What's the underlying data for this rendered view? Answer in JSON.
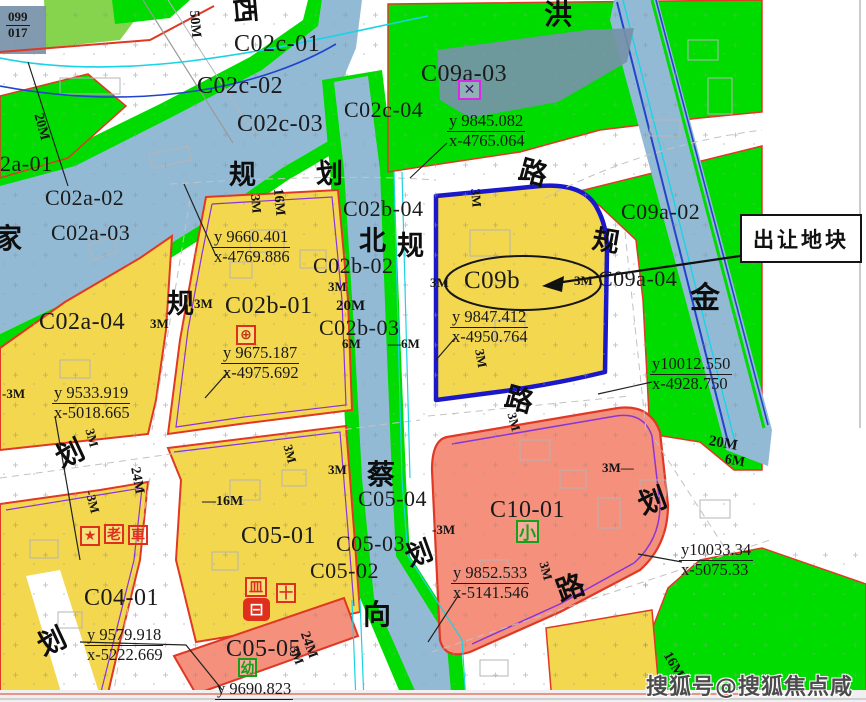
{
  "callout": {
    "label": "出让地块"
  },
  "watermark": {
    "text": "搜狐号@搜狐焦点咸宁站"
  },
  "highlight_parcel": {
    "id": "C09b"
  },
  "colors": {
    "green": "#00dc00",
    "ygreen": "#86d44e",
    "yellow": "#f3d84f",
    "water": "#93bad5",
    "salmon": "#f4907c",
    "slate": "#7691a9",
    "red-border": "#e03824",
    "navy": "#1a18c8",
    "violet": "#8a35d6",
    "cyan": "#19d3e6",
    "blue-line": "#2244cc",
    "magenta": "#d928e8",
    "icon-red": "#df2f1d",
    "icon-green": "#18a018"
  },
  "labels": [
    {
      "t": "C02c-01",
      "x": 234,
      "y": 32,
      "fs": 24,
      "k": "parcel"
    },
    {
      "t": "C02c-02",
      "x": 197,
      "y": 74,
      "fs": 24,
      "k": "parcel"
    },
    {
      "t": "C02c-03",
      "x": 237,
      "y": 112,
      "fs": 24,
      "k": "parcel"
    },
    {
      "t": "C02c-04",
      "x": 344,
      "y": 99,
      "fs": 22,
      "k": "parcel"
    },
    {
      "t": "C09a-03",
      "x": 421,
      "y": 62,
      "fs": 24,
      "k": "parcel"
    },
    {
      "t": "C02b-04",
      "x": 343,
      "y": 198,
      "fs": 22,
      "k": "parcel"
    },
    {
      "t": "C09a-02",
      "x": 621,
      "y": 201,
      "fs": 22,
      "k": "parcel"
    },
    {
      "t": "2a-01",
      "x": 0,
      "y": 153,
      "fs": 22,
      "k": "parcel"
    },
    {
      "t": "C02a-02",
      "x": 45,
      "y": 187,
      "fs": 22,
      "k": "parcel"
    },
    {
      "t": "C02a-03",
      "x": 51,
      "y": 222,
      "fs": 22,
      "k": "parcel"
    },
    {
      "t": "C02b-02",
      "x": 313,
      "y": 255,
      "fs": 22,
      "k": "parcel"
    },
    {
      "t": "C02b-01",
      "x": 225,
      "y": 294,
      "fs": 24,
      "k": "parcel"
    },
    {
      "t": "C02b-03",
      "x": 319,
      "y": 317,
      "fs": 22,
      "k": "parcel"
    },
    {
      "t": "C02a-04",
      "x": 39,
      "y": 310,
      "fs": 24,
      "k": "parcel"
    },
    {
      "t": "C09a-04",
      "x": 598,
      "y": 268,
      "fs": 22,
      "k": "parcel"
    },
    {
      "t": "C09b",
      "x": 464,
      "y": 268,
      "fs": 25,
      "k": "parcel"
    },
    {
      "t": "C05-04",
      "x": 358,
      "y": 488,
      "fs": 22,
      "k": "parcel"
    },
    {
      "t": "C05-01",
      "x": 241,
      "y": 524,
      "fs": 24,
      "k": "parcel"
    },
    {
      "t": "C05-03",
      "x": 336,
      "y": 533,
      "fs": 22,
      "k": "parcel"
    },
    {
      "t": "C05-02",
      "x": 310,
      "y": 560,
      "fs": 22,
      "k": "parcel"
    },
    {
      "t": "C10-01",
      "x": 490,
      "y": 498,
      "fs": 24,
      "k": "parcel"
    },
    {
      "t": "C04-01",
      "x": 84,
      "y": 586,
      "fs": 24,
      "k": "parcel"
    },
    {
      "t": "C05-05",
      "x": 226,
      "y": 637,
      "fs": 24,
      "k": "parcel"
    },
    {
      "t": "西",
      "x": 256,
      "y": -4,
      "fs": 26,
      "k": "roadchar",
      "r": 85
    },
    {
      "t": "洪",
      "x": 544,
      "y": 2,
      "fs": 28,
      "k": "roadchar"
    },
    {
      "t": "家",
      "x": -6,
      "y": 226,
      "fs": 28,
      "k": "roadchar"
    },
    {
      "t": "规",
      "x": 229,
      "y": 162,
      "fs": 27,
      "k": "roadchar"
    },
    {
      "t": "划",
      "x": 316,
      "y": 161,
      "fs": 27,
      "k": "roadchar"
    },
    {
      "t": "北",
      "x": 359,
      "y": 228,
      "fs": 27,
      "k": "roadchar"
    },
    {
      "t": "规",
      "x": 397,
      "y": 233,
      "fs": 27,
      "k": "roadchar"
    },
    {
      "t": "规",
      "x": 595,
      "y": 226,
      "fs": 27,
      "k": "roadchar",
      "r": 10
    },
    {
      "t": "金",
      "x": 690,
      "y": 284,
      "fs": 30,
      "k": "roadchar"
    },
    {
      "t": "规",
      "x": 167,
      "y": 291,
      "fs": 27,
      "k": "roadchar"
    },
    {
      "t": "路",
      "x": 523,
      "y": 157,
      "fs": 28,
      "k": "roadchar",
      "r": 15
    },
    {
      "t": "划",
      "x": 52,
      "y": 448,
      "fs": 28,
      "k": "roadchar",
      "r": -25
    },
    {
      "t": "蔡",
      "x": 367,
      "y": 462,
      "fs": 28,
      "k": "roadchar"
    },
    {
      "t": "划",
      "x": 402,
      "y": 546,
      "fs": 27,
      "k": "roadchar",
      "r": -20
    },
    {
      "t": "路",
      "x": 509,
      "y": 384,
      "fs": 28,
      "k": "roadchar",
      "r": 15
    },
    {
      "t": "向",
      "x": 363,
      "y": 602,
      "fs": 28,
      "k": "roadchar"
    },
    {
      "t": "划",
      "x": 635,
      "y": 494,
      "fs": 28,
      "k": "roadchar",
      "r": -20
    },
    {
      "t": "路",
      "x": 553,
      "y": 581,
      "fs": 28,
      "k": "roadchar",
      "r": -20
    },
    {
      "t": "划",
      "x": 34,
      "y": 636,
      "fs": 28,
      "k": "roadchar",
      "r": -25
    },
    {
      "t": "50M",
      "x": 200,
      "y": 10,
      "fs": 14,
      "k": "dim",
      "r": 85
    },
    {
      "t": "20M",
      "x": 44,
      "y": 112,
      "fs": 14,
      "k": "dim",
      "r": 75
    },
    {
      "t": "3M",
      "x": 262,
      "y": 194,
      "fs": 13,
      "k": "dim",
      "r": 85
    },
    {
      "t": "16M",
      "x": 284,
      "y": 188,
      "fs": 14,
      "k": "dim",
      "r": 85
    },
    {
      "t": "3M",
      "x": 482,
      "y": 188,
      "fs": 13,
      "k": "dim",
      "r": 85
    },
    {
      "t": "3M",
      "x": 328,
      "y": 280,
      "fs": 13,
      "k": "dim"
    },
    {
      "t": "20M",
      "x": 336,
      "y": 299,
      "fs": 15,
      "k": "dim"
    },
    {
      "t": "3M",
      "x": 194,
      "y": 297,
      "fs": 13,
      "k": "dim"
    },
    {
      "t": "6M",
      "x": 342,
      "y": 337,
      "fs": 13,
      "k": "dim"
    },
    {
      "t": "—6M",
      "x": 388,
      "y": 337,
      "fs": 13,
      "k": "dim"
    },
    {
      "t": "3M",
      "x": 150,
      "y": 317,
      "fs": 13,
      "k": "dim"
    },
    {
      "t": "3M",
      "x": 430,
      "y": 276,
      "fs": 13,
      "k": "dim"
    },
    {
      "t": "3M",
      "x": 574,
      "y": 274,
      "fs": 13,
      "k": "dim"
    },
    {
      "t": "-3M",
      "x": 2,
      "y": 387,
      "fs": 13,
      "k": "dim"
    },
    {
      "t": "3M",
      "x": 96,
      "y": 427,
      "fs": 13,
      "k": "dim",
      "r": 75
    },
    {
      "t": "-3M",
      "x": 96,
      "y": 489,
      "fs": 13,
      "k": "dim",
      "r": 75
    },
    {
      "t": "24M",
      "x": 141,
      "y": 466,
      "fs": 14,
      "k": "dim",
      "r": 80
    },
    {
      "t": "—16M",
      "x": 202,
      "y": 495,
      "fs": 14,
      "k": "dim"
    },
    {
      "t": "3M",
      "x": 294,
      "y": 443,
      "fs": 13,
      "k": "dim",
      "r": 75
    },
    {
      "t": "3M",
      "x": 328,
      "y": 463,
      "fs": 13,
      "k": "dim"
    },
    {
      "t": "3M",
      "x": 486,
      "y": 348,
      "fs": 13,
      "k": "dim",
      "r": 80
    },
    {
      "t": "-3M",
      "x": 432,
      "y": 523,
      "fs": 13,
      "k": "dim"
    },
    {
      "t": "3M—",
      "x": 602,
      "y": 461,
      "fs": 13,
      "k": "dim"
    },
    {
      "t": "3M",
      "x": 518,
      "y": 411,
      "fs": 13,
      "k": "dim",
      "r": 75
    },
    {
      "t": "3M",
      "x": 550,
      "y": 560,
      "fs": 13,
      "k": "dim",
      "r": 75
    },
    {
      "t": "24M",
      "x": 310,
      "y": 630,
      "fs": 14,
      "k": "dim",
      "r": 70
    },
    {
      "t": "3M",
      "x": 300,
      "y": 644,
      "fs": 13,
      "k": "dim",
      "r": 70
    },
    {
      "t": "20M",
      "x": 710,
      "y": 434,
      "fs": 15,
      "k": "dim",
      "r": 10
    },
    {
      "t": "6M",
      "x": 726,
      "y": 453,
      "fs": 14,
      "k": "dim",
      "r": 10
    },
    {
      "t": "16M",
      "x": 672,
      "y": 650,
      "fs": 14,
      "k": "dim",
      "r": 60
    }
  ],
  "coords": [
    {
      "y": "y 9845.082",
      "x": "x-4765.064",
      "px": 447,
      "py": 112
    },
    {
      "y": "y 9660.401",
      "x": "x-4769.886",
      "px": 212,
      "py": 228
    },
    {
      "y": "y 9675.187",
      "x": "x-4975.692",
      "px": 221,
      "py": 344
    },
    {
      "y": "y 9533.919",
      "x": "x-5018.665",
      "px": 52,
      "py": 384
    },
    {
      "y": "y 9847.412",
      "x": "x-4950.764",
      "px": 450,
      "py": 308
    },
    {
      "y": "y10012.550",
      "x": "x-4928.750",
      "px": 650,
      "py": 355
    },
    {
      "y": "y 9852.533",
      "x": "x-5141.546",
      "px": 451,
      "py": 564
    },
    {
      "y": "y 9579.918",
      "x": "x-5222.669",
      "px": 85,
      "py": 626
    },
    {
      "y": "y 9690.823",
      "x": "",
      "px": 215,
      "py": 680
    },
    {
      "y": "y10033.34",
      "x": "x-5075.33",
      "px": 679,
      "py": 541
    },
    {
      "y": "099",
      "x": "017",
      "px": 6,
      "py": 10,
      "small": true
    }
  ],
  "icons": [
    {
      "name": "station-marker-icon",
      "g": "✕",
      "x": 458,
      "y": 80,
      "w": 23,
      "h": 20,
      "c": "magenta",
      "gc": "#3d1a66"
    },
    {
      "name": "landmark-icon",
      "g": "⊕",
      "x": 236,
      "y": 325,
      "w": 20,
      "h": 20,
      "c": "icon-red",
      "gc": "#c03010"
    },
    {
      "name": "star-landmark-icon",
      "g": "★",
      "x": 80,
      "y": 526,
      "w": 20,
      "h": 20,
      "c": "icon-red",
      "gc": "#df2f1d"
    },
    {
      "name": "elder-care-icon",
      "g": "老",
      "x": 104,
      "y": 524,
      "w": 20,
      "h": 20,
      "c": "icon-red",
      "gc": "#df2f1d"
    },
    {
      "name": "transport-icon",
      "g": "車",
      "x": 128,
      "y": 525,
      "w": 20,
      "h": 20,
      "c": "icon-red",
      "gc": "#df2f1d"
    },
    {
      "name": "market-icon",
      "g": "皿",
      "x": 245,
      "y": 577,
      "w": 22,
      "h": 20,
      "c": "icon-red",
      "gc": "#df2f1d"
    },
    {
      "name": "clinic-icon",
      "g": "十",
      "x": 276,
      "y": 583,
      "w": 20,
      "h": 20,
      "c": "icon-red",
      "gc": "#df2f1d"
    },
    {
      "name": "bus-depot-icon",
      "g": "⊟",
      "x": 243,
      "y": 598,
      "w": 27,
      "h": 23,
      "c": "icon-red",
      "solid": true
    },
    {
      "name": "primary-school-icon",
      "g": "小",
      "x": 516,
      "y": 520,
      "w": 23,
      "h": 23,
      "c": "icon-green",
      "gc": "#18a018"
    },
    {
      "name": "kindergarten-icon",
      "g": "幼",
      "x": 238,
      "y": 658,
      "w": 19,
      "h": 19,
      "c": "icon-green",
      "gc": "#18a018"
    }
  ]
}
